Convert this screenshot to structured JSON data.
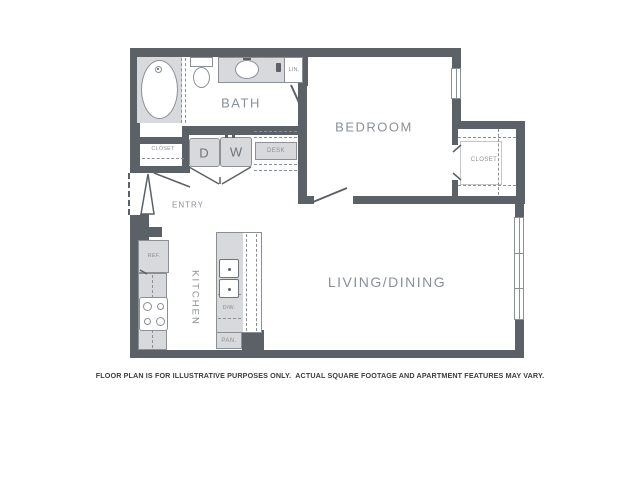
{
  "floorplan": {
    "rooms": {
      "bath": "BATH",
      "bedroom": "BEDROOM",
      "living_dining": "LIVING/DINING",
      "entry": "ENTRY",
      "kitchen": "KITCHEN"
    },
    "fixtures": {
      "entry_closet": "CLOSET",
      "bedroom_closet": "CLOSET",
      "linen_closet": "LIN.",
      "desk": "DESK",
      "dryer": "D",
      "washer": "W",
      "refrigerator": "REF.",
      "dishwasher": "D/W.",
      "pantry": "PAN."
    },
    "disclaimer": "FLOOR PLAN IS FOR ILLUSTRATIVE PURPOSES ONLY.  ACTUAL SQUARE FOOTAGE AND APARTMENT FEATURES MAY VARY.",
    "colors": {
      "wall": "#5c6167",
      "fixture_fill": "#d7d9dc",
      "fixture_border": "#8b9097",
      "room_label": "#8a9098",
      "disclaimer_text": "#3d3d3d",
      "background": "#ffffff"
    }
  }
}
